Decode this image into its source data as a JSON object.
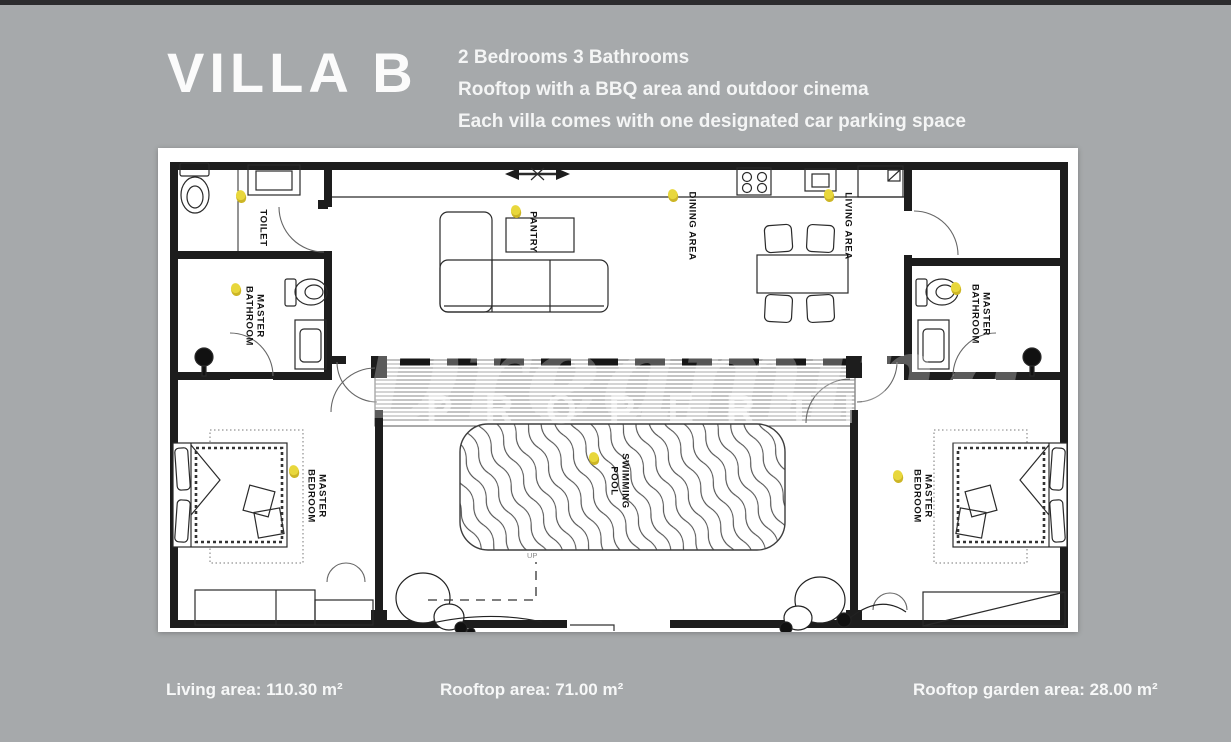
{
  "header": {
    "title": "VILLA B",
    "description_lines": [
      "2 Bedrooms 3 Bathrooms",
      "Rooftop with a BBQ area and outdoor cinema",
      "Each villa comes with one designated car parking space"
    ]
  },
  "floorplan": {
    "rooms": [
      {
        "id": "toilet",
        "label_lines": [
          "TOILET"
        ]
      },
      {
        "id": "master-bathroom-left",
        "label_lines": [
          "MASTER",
          "BATHROOM"
        ]
      },
      {
        "id": "pantry",
        "label_lines": [
          "PANTRY"
        ]
      },
      {
        "id": "dining-area",
        "label_lines": [
          "DINING AREA"
        ]
      },
      {
        "id": "living-area",
        "label_lines": [
          "LIVING AREA"
        ]
      },
      {
        "id": "master-bathroom-right",
        "label_lines": [
          "MASTER",
          "BATHROOM"
        ]
      },
      {
        "id": "master-bedroom-left",
        "label_lines": [
          "MASTER",
          "BEDROOM"
        ]
      },
      {
        "id": "swimming-pool",
        "label_lines": [
          "SWIMMING",
          "POOL"
        ]
      },
      {
        "id": "master-bedroom-right",
        "label_lines": [
          "MASTER",
          "BEDROOM"
        ]
      }
    ],
    "stair_label": "UP",
    "lamp_color": "#e8d73c",
    "wall_color": "#1d1d1d"
  },
  "watermark": {
    "script_text": "Dreaming",
    "caps_text": "PROPERTIES"
  },
  "stats": [
    {
      "text": "Living area: 110.30 m²"
    },
    {
      "text": "Rooftop area: 71.00 m²"
    },
    {
      "text": "Rooftop garden area: 28.00 m²"
    }
  ]
}
